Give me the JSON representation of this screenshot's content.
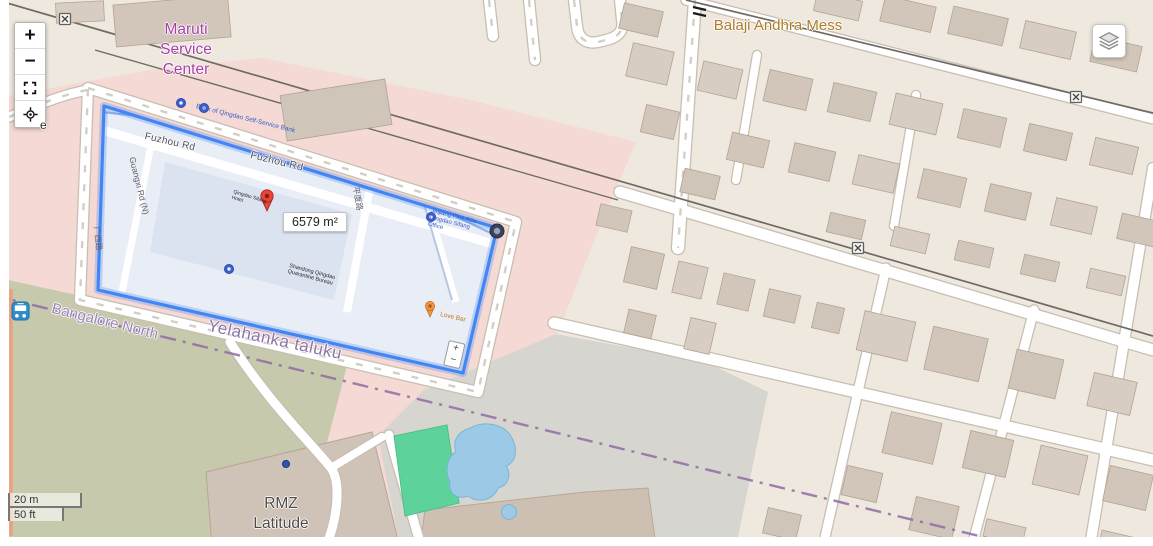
{
  "controls": {
    "zoom_in_label": "+",
    "zoom_out_label": "−",
    "fullscreen_icon": "fullscreen-expand",
    "locate_icon": "crosshair-locate",
    "layers_icon": "layers-stack"
  },
  "scale_bar": {
    "metric": "20 m",
    "imperial": "50 ft"
  },
  "measurement": {
    "area_label": "6579 m²"
  },
  "place_labels": {
    "maruti": "Maruti Service Center",
    "balaji": "Balaji Andhra Mess",
    "yelahanka": "Yelahanka taluku",
    "bangalore_north": "Bangalore North",
    "rmz": "RMZ Latitude",
    "road_fragment": "e"
  },
  "inset_map": {
    "road_labels": {
      "fuzhou_1": "Fuzhou Rd",
      "fuzhou_2": "Fuzhou Rd",
      "guangxi": "Guangxi Rd (N)",
      "guangxi_cjk": "广西路",
      "pingdu_cjk": "平度路"
    },
    "poi_labels": {
      "bank": "Bank of Qingdao Self-Service Bank",
      "jinjiang": "Jinjiang Pine Atta Qingdao Sifang Office",
      "bureau": "Shandong Qingdao Quarantine Bureau",
      "hotel": "Qingdao Sifang Hotel",
      "love_bar": "Love Bar"
    },
    "mini_zoom_in": "+",
    "mini_zoom_out": "−"
  },
  "colors": {
    "polygon_stroke": "#4285f4",
    "pink_area": "#f4d9d4",
    "green_area": "#c6c9ab",
    "campus_gray": "#d7d5d0",
    "pitch_green": "#5dd39b",
    "water_blue": "#9ccae6",
    "boundary_purple": "#8f6ba3",
    "label_purple": "#a73fa5",
    "label_orange": "#ad7c27",
    "railway_gray": "#6f6a64"
  }
}
